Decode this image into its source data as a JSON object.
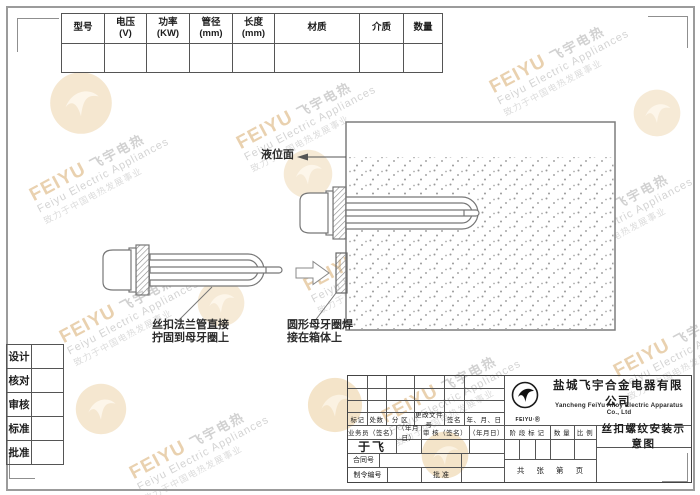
{
  "spec_table": {
    "headers": [
      "型号",
      "电压\n(V)",
      "功率\n(KW)",
      "管径\n(mm)",
      "长度\n(mm)",
      "材质",
      "介质",
      "数量"
    ]
  },
  "sidebar": {
    "items": [
      {
        "label": "设计"
      },
      {
        "label": "核对"
      },
      {
        "label": "审核"
      },
      {
        "label": "标准"
      },
      {
        "label": "批准"
      }
    ]
  },
  "diagram": {
    "liquid_level_label": "液位面",
    "flange_note_line1": "丝扣法兰管直接",
    "flange_note_line2": "拧固到母牙圈上",
    "ring_note_line1": "圆形母牙圈焊",
    "ring_note_line2": "接在箱体上"
  },
  "title_block": {
    "revision_headers": [
      "标记",
      "处数",
      "分 区",
      "更改文件号",
      "签名",
      "年、月、日"
    ],
    "sign_headers": [
      "业务员（签名）",
      "（年月日）",
      "审 核（签名）",
      "（年月日）"
    ],
    "signer_name": "于飞",
    "contract_label": "合同号",
    "order_label": "制令编号",
    "approve_label": "批 准",
    "stage_mark_label": "阶 段 标 记",
    "quantity_label": "数 量",
    "scale_label": "比 例",
    "sheet_info": "共 张 第 页",
    "drawing_title": "丝扣螺纹安装示意图",
    "company_cn": "盐城飞宇合金电器有限公司",
    "company_en": "Yancheng FeiYu Alloy Electric Apparatus Co., Ltd",
    "logo_caption": "FEIYU·Ⓡ"
  },
  "watermark": {
    "brand": "FEIYU",
    "brand_cn": "飞宇电热",
    "line_en": "Feiyu Electric Appliances",
    "slogan": "致力于中国电热发展事业"
  }
}
